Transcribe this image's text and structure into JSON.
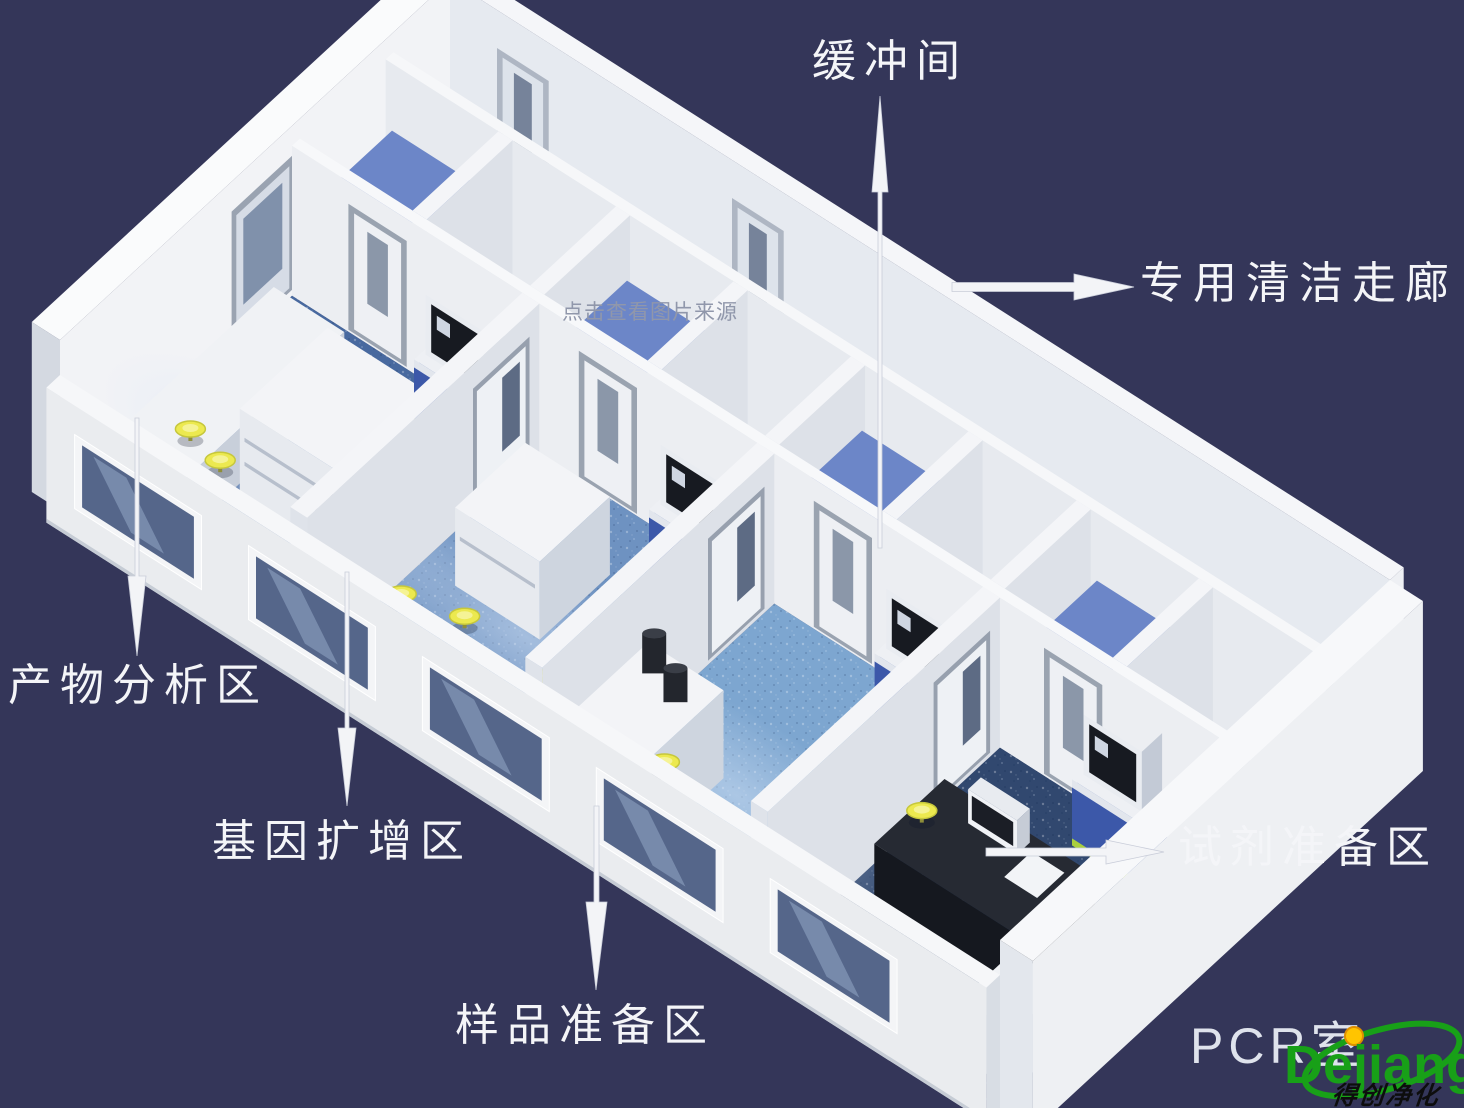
{
  "annotations": {
    "buffer_room": "缓冲间",
    "clean_corridor": "专用清洁走廊",
    "product_analysis": "产物分析区",
    "gene_amplification": "基因扩增区",
    "sample_preparation": "样品准备区",
    "reagent_preparation": "试剂准备区"
  },
  "watermark": {
    "text": "点击查看图片来源"
  },
  "caption": {
    "room_label": "PCR室"
  },
  "logo": {
    "wordmark": "Dejiang",
    "tagline": "得创净化"
  },
  "colors": {
    "background": "#343659",
    "label_text": "#f4f5f8",
    "arrow_white": "#f3f4f7",
    "wall_white": "#eef0f4",
    "floor_room1_blue": "#48699f",
    "floor_room2_blue": "#6e92c1",
    "floor_room3_blue": "#7da6d0",
    "floor_room4_navy": "#31486f",
    "corridor_floor_gray": "#d7dbe2",
    "buffer_floor_gray": "#ccd1d9",
    "cabinet_blue": "#4059ac",
    "stool_yellow": "#ece94f",
    "equipment_trim_green": "#a9cf3e",
    "watermark_gray": "#9097ab",
    "pcr_caption": "#dfe3ec",
    "logo_green": "#18a018",
    "logo_dot_yellow": "#ffc400",
    "logo_tagline_black": "#0d0d0d"
  }
}
